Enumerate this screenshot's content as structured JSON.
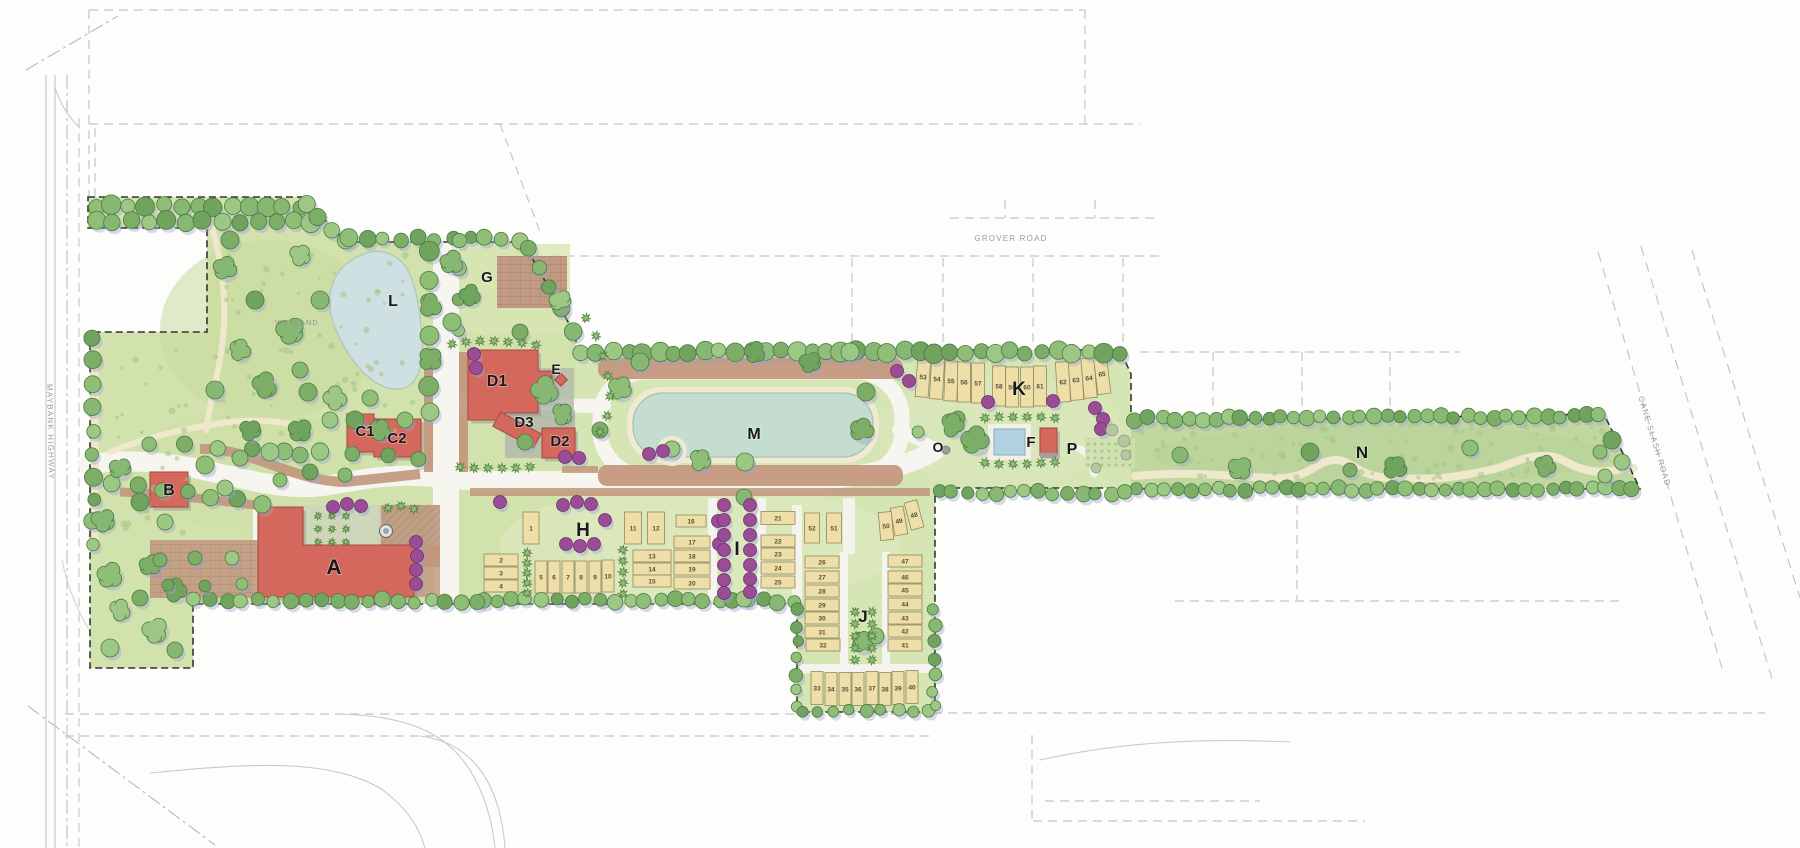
{
  "road_labels": {
    "grover": {
      "text": "GROVER ROAD",
      "x": 1011,
      "y": 241,
      "rot": 0,
      "size": 8
    },
    "maybank": {
      "text": "MAYBANK HIGHWAY",
      "x": 48,
      "y": 432,
      "rot": 89,
      "size": 8
    },
    "cane_slash": {
      "text": "CANE SLASH ROAD",
      "x": 1652,
      "y": 442,
      "rot": 73,
      "size": 8
    }
  },
  "annotations": {
    "wetland": {
      "text": "WETLAND",
      "x": 297,
      "y": 325,
      "size": 7.5
    }
  },
  "area_labels": [
    {
      "id": "A",
      "label": "A",
      "x": 334,
      "y": 574,
      "size": 21
    },
    {
      "id": "B",
      "label": "B",
      "x": 169,
      "y": 495,
      "size": 16
    },
    {
      "id": "C1",
      "label": "C1",
      "x": 365,
      "y": 436,
      "size": 15
    },
    {
      "id": "C2",
      "label": "C2",
      "x": 397,
      "y": 443,
      "size": 15
    },
    {
      "id": "D1",
      "label": "D1",
      "x": 497,
      "y": 386,
      "size": 16
    },
    {
      "id": "D2",
      "label": "D2",
      "x": 560,
      "y": 446,
      "size": 15
    },
    {
      "id": "D3",
      "label": "D3",
      "x": 524,
      "y": 427,
      "size": 15
    },
    {
      "id": "E",
      "label": "E",
      "x": 556,
      "y": 374,
      "size": 14
    },
    {
      "id": "F",
      "label": "F",
      "x": 1031,
      "y": 447,
      "size": 15
    },
    {
      "id": "G",
      "label": "G",
      "x": 487,
      "y": 282,
      "size": 15
    },
    {
      "id": "H",
      "label": "H",
      "x": 583,
      "y": 536,
      "size": 19
    },
    {
      "id": "I",
      "label": "I",
      "x": 737,
      "y": 555,
      "size": 19
    },
    {
      "id": "J",
      "label": "J",
      "x": 863,
      "y": 622,
      "size": 17
    },
    {
      "id": "K",
      "label": "K",
      "x": 1019,
      "y": 395,
      "size": 19
    },
    {
      "id": "L",
      "label": "L",
      "x": 393,
      "y": 306,
      "size": 16
    },
    {
      "id": "M",
      "label": "M",
      "x": 754,
      "y": 439,
      "size": 16
    },
    {
      "id": "N",
      "label": "N",
      "x": 1362,
      "y": 458,
      "size": 17
    },
    {
      "id": "O",
      "label": "O",
      "x": 938,
      "y": 452,
      "size": 14
    },
    {
      "id": "P",
      "label": "P",
      "x": 1072,
      "y": 454,
      "size": 16
    }
  ],
  "lots": [
    {
      "n": "1",
      "x": 531,
      "y": 528,
      "w": 16,
      "h": 32
    },
    {
      "n": "2",
      "x": 501,
      "y": 560,
      "w": 34,
      "h": 12
    },
    {
      "n": "3",
      "x": 501,
      "y": 573,
      "w": 34,
      "h": 12
    },
    {
      "n": "4",
      "x": 501,
      "y": 586,
      "w": 34,
      "h": 12
    },
    {
      "n": "5",
      "x": 541,
      "y": 577,
      "w": 12,
      "h": 32
    },
    {
      "n": "6",
      "x": 554,
      "y": 577,
      "w": 12,
      "h": 32
    },
    {
      "n": "7",
      "x": 568,
      "y": 577,
      "w": 12,
      "h": 32
    },
    {
      "n": "8",
      "x": 581,
      "y": 577,
      "w": 12,
      "h": 32
    },
    {
      "n": "9",
      "x": 595,
      "y": 577,
      "w": 12,
      "h": 32
    },
    {
      "n": "10",
      "x": 608,
      "y": 576,
      "w": 12,
      "h": 32
    },
    {
      "n": "11",
      "x": 633,
      "y": 528,
      "w": 17,
      "h": 32
    },
    {
      "n": "12",
      "x": 656,
      "y": 528,
      "w": 17,
      "h": 32
    },
    {
      "n": "13",
      "x": 652,
      "y": 556,
      "w": 38,
      "h": 12
    },
    {
      "n": "14",
      "x": 652,
      "y": 569,
      "w": 38,
      "h": 12
    },
    {
      "n": "15",
      "x": 652,
      "y": 581,
      "w": 38,
      "h": 12
    },
    {
      "n": "16",
      "x": 691,
      "y": 521,
      "w": 30,
      "h": 12
    },
    {
      "n": "17",
      "x": 692,
      "y": 542,
      "w": 36,
      "h": 12
    },
    {
      "n": "18",
      "x": 692,
      "y": 556,
      "w": 36,
      "h": 12
    },
    {
      "n": "19",
      "x": 692,
      "y": 569,
      "w": 36,
      "h": 12
    },
    {
      "n": "20",
      "x": 692,
      "y": 583,
      "w": 36,
      "h": 12
    },
    {
      "n": "21",
      "x": 778,
      "y": 518,
      "w": 34,
      "h": 13
    },
    {
      "n": "22",
      "x": 778,
      "y": 541,
      "w": 34,
      "h": 12
    },
    {
      "n": "23",
      "x": 778,
      "y": 554,
      "w": 34,
      "h": 12
    },
    {
      "n": "24",
      "x": 778,
      "y": 568,
      "w": 34,
      "h": 12
    },
    {
      "n": "25",
      "x": 778,
      "y": 582,
      "w": 34,
      "h": 12
    },
    {
      "n": "26",
      "x": 822,
      "y": 562,
      "w": 34,
      "h": 12
    },
    {
      "n": "27",
      "x": 822,
      "y": 577,
      "w": 34,
      "h": 12
    },
    {
      "n": "28",
      "x": 822,
      "y": 591,
      "w": 34,
      "h": 12
    },
    {
      "n": "29",
      "x": 822,
      "y": 605,
      "w": 34,
      "h": 12
    },
    {
      "n": "30",
      "x": 822,
      "y": 618,
      "w": 34,
      "h": 12
    },
    {
      "n": "31",
      "x": 822,
      "y": 632,
      "w": 34,
      "h": 12
    },
    {
      "n": "32",
      "x": 823,
      "y": 645,
      "w": 34,
      "h": 12
    },
    {
      "n": "33",
      "x": 817,
      "y": 688,
      "w": 12,
      "h": 33
    },
    {
      "n": "34",
      "x": 831,
      "y": 689,
      "w": 12,
      "h": 33
    },
    {
      "n": "35",
      "x": 845,
      "y": 689,
      "w": 12,
      "h": 33
    },
    {
      "n": "36",
      "x": 858,
      "y": 689,
      "w": 12,
      "h": 33
    },
    {
      "n": "37",
      "x": 872,
      "y": 688,
      "w": 12,
      "h": 33
    },
    {
      "n": "38",
      "x": 885,
      "y": 689,
      "w": 12,
      "h": 33
    },
    {
      "n": "39",
      "x": 898,
      "y": 688,
      "w": 12,
      "h": 33
    },
    {
      "n": "40",
      "x": 912,
      "y": 687,
      "w": 12,
      "h": 33
    },
    {
      "n": "41",
      "x": 905,
      "y": 645,
      "w": 34,
      "h": 12
    },
    {
      "n": "42",
      "x": 905,
      "y": 631,
      "w": 34,
      "h": 12
    },
    {
      "n": "43",
      "x": 905,
      "y": 618,
      "w": 34,
      "h": 12
    },
    {
      "n": "44",
      "x": 905,
      "y": 604,
      "w": 34,
      "h": 12
    },
    {
      "n": "45",
      "x": 905,
      "y": 590,
      "w": 34,
      "h": 12
    },
    {
      "n": "46",
      "x": 905,
      "y": 577,
      "w": 34,
      "h": 12
    },
    {
      "n": "47",
      "x": 905,
      "y": 561,
      "w": 34,
      "h": 12
    },
    {
      "n": "48",
      "x": 914,
      "y": 515,
      "w": 13,
      "h": 28,
      "r": -15
    },
    {
      "n": "49",
      "x": 899,
      "y": 521,
      "w": 13,
      "h": 28,
      "r": -10
    },
    {
      "n": "50",
      "x": 886,
      "y": 526,
      "w": 13,
      "h": 28,
      "r": -5
    },
    {
      "n": "51",
      "x": 834,
      "y": 528,
      "w": 15,
      "h": 30
    },
    {
      "n": "52",
      "x": 812,
      "y": 528,
      "w": 15,
      "h": 30
    },
    {
      "n": "53",
      "x": 923,
      "y": 377,
      "w": 13,
      "h": 40,
      "r": 4
    },
    {
      "n": "54",
      "x": 937,
      "y": 379,
      "w": 13,
      "h": 40,
      "r": 3
    },
    {
      "n": "55",
      "x": 951,
      "y": 381,
      "w": 13,
      "h": 40,
      "r": 2
    },
    {
      "n": "56",
      "x": 964,
      "y": 382,
      "w": 13,
      "h": 40
    },
    {
      "n": "57",
      "x": 978,
      "y": 383,
      "w": 13,
      "h": 40
    },
    {
      "n": "58",
      "x": 999,
      "y": 386,
      "w": 13,
      "h": 40
    },
    {
      "n": "59",
      "x": 1012,
      "y": 387,
      "w": 13,
      "h": 40
    },
    {
      "n": "60",
      "x": 1027,
      "y": 387,
      "w": 13,
      "h": 40
    },
    {
      "n": "61",
      "x": 1040,
      "y": 386,
      "w": 13,
      "h": 40
    },
    {
      "n": "62",
      "x": 1063,
      "y": 382,
      "w": 13,
      "h": 40,
      "r": -3
    },
    {
      "n": "63",
      "x": 1076,
      "y": 380,
      "w": 13,
      "h": 40,
      "r": -4
    },
    {
      "n": "64",
      "x": 1089,
      "y": 378,
      "w": 13,
      "h": 40,
      "r": -5
    },
    {
      "n": "65",
      "x": 1102,
      "y": 374,
      "w": 13,
      "h": 40,
      "r": -7
    }
  ],
  "colors": {
    "building": "#d5685c",
    "building_edge": "#a84b41",
    "lot_fill": "#eedfa8",
    "lot_edge": "#93895e",
    "lot_num": "#564f38",
    "pond": "#c5ddd0",
    "pond_edge": "#a3c4b2",
    "wetland_pond": "#cfe0e2",
    "pool": "#b1d0e0",
    "purple_tree": "#9b4c97",
    "lawn": "#d6e5b4",
    "meadow": "#c3d9a2",
    "tree_green": "#85b471",
    "boundary": "#333333",
    "plaza_brown": "#c2967c",
    "label": "#191919",
    "road_label": "#9b9b9b",
    "wetland_label": "#8e948a"
  }
}
